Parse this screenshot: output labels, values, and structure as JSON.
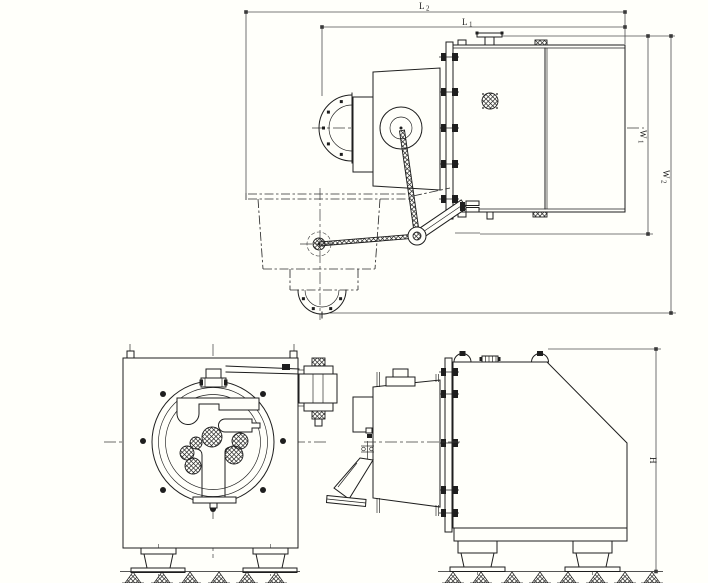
{
  "drawing": {
    "colors": {
      "paper": "#fffffa",
      "ink": "#1e1e1e",
      "dim": "#4f4f4f"
    },
    "dimension_labels": {
      "l2": {
        "letter": "L",
        "sub": "2"
      },
      "l1": {
        "letter": "L",
        "sub": "1"
      },
      "w1": {
        "letter": "W",
        "sub": "1"
      },
      "w2": {
        "letter": "W",
        "sub": "2"
      },
      "h": {
        "letter": "H",
        "sub": ""
      }
    }
  }
}
